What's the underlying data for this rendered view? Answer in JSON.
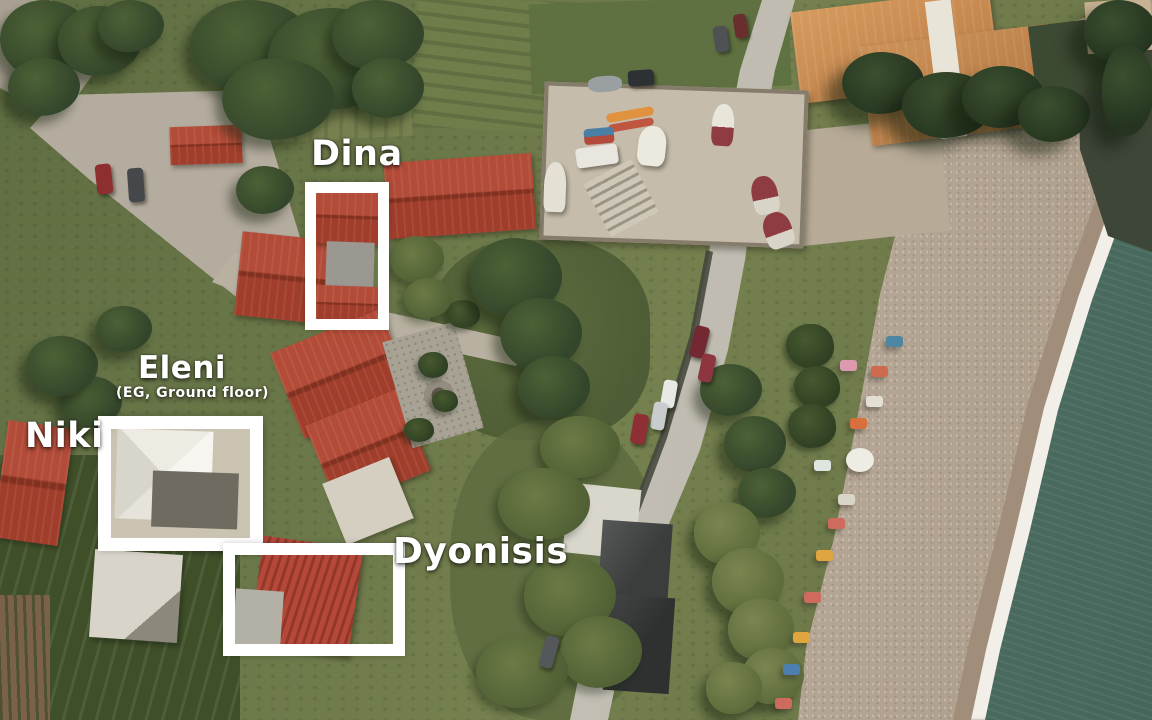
{
  "scene": {
    "type": "aerial-drone-photo",
    "description": "Aerial view of a seaside village: beach with sun loungers, sea, coastal road, red-roofed houses, with white boxes marking labeled guest houses"
  },
  "location_labels": {
    "dina": {
      "label": "Dina"
    },
    "eleni": {
      "label": "Eleni",
      "sublabel": "(EG, Ground floor)"
    },
    "niki": {
      "label": "Niki"
    },
    "dyonisis": {
      "label": "Dyonisis"
    }
  },
  "palette": {
    "marker_outline": "#ffffff",
    "label_text": "#ffffff",
    "sea": "#52756a",
    "surf_foam": "#f2efe8",
    "sand": "#b7a99a",
    "roof_red": "#a8402f",
    "hotel_terracotta": "#cd9055",
    "vegetation_dark": "#3c4d2a",
    "road_grey": "#bcb8ad"
  }
}
